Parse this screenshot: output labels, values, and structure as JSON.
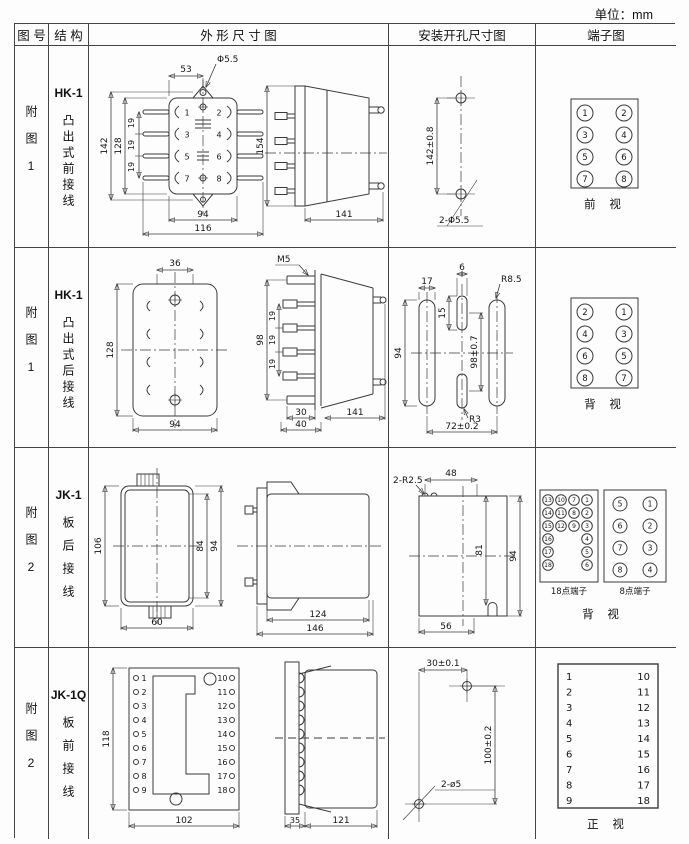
{
  "unit_label": "单位：mm",
  "header": {
    "figure": "图 号",
    "structure": "结 构",
    "outline": "外 形 尺 寸 图",
    "mounting": "安装开孔尺寸图",
    "terminal": "端子图"
  },
  "rows": [
    {
      "figure": "附图1",
      "model": "HK-1",
      "desc": "凸出式前接线",
      "outline": {
        "d53": "53",
        "dphi": "Φ5.5",
        "d142": "142",
        "d128": "128",
        "d19a": "19",
        "d19b": "19",
        "d19c": "19",
        "d94": "94",
        "d116": "116",
        "d154": "154",
        "d141": "141",
        "pins": [
          "1",
          "2",
          "3",
          "4",
          "5",
          "6",
          "7",
          "8"
        ]
      },
      "mounting": {
        "d142": "142±0.8",
        "holes": "2-Φ5.5"
      },
      "terminal": {
        "cells": [
          [
            "1",
            "2"
          ],
          [
            "3",
            "4"
          ],
          [
            "5",
            "6"
          ],
          [
            "7",
            "8"
          ]
        ],
        "view": "前 视"
      }
    },
    {
      "figure": "附图1",
      "model": "HK-1",
      "desc": "凸出式后接线",
      "outline": {
        "d36": "36",
        "d128": "128",
        "d94": "94",
        "m5": "M5",
        "d98": "98",
        "d19a": "19",
        "d19b": "19",
        "d19c": "19",
        "d30": "30",
        "d40": "40",
        "d141": "141"
      },
      "mounting": {
        "d17": "17",
        "d6": "6",
        "d15": "15",
        "d94": "94",
        "d98": "98±0.7",
        "r85": "R8.5",
        "r3": "R3",
        "d72": "72±0.2"
      },
      "terminal": {
        "cells": [
          [
            "2",
            "1"
          ],
          [
            "4",
            "3"
          ],
          [
            "6",
            "5"
          ],
          [
            "8",
            "7"
          ]
        ],
        "view": "背 视"
      }
    },
    {
      "figure": "附图2",
      "model": "JK-1",
      "desc": "板后接线",
      "outline": {
        "d106": "106",
        "d60": "60",
        "d84": "84",
        "d94": "94",
        "d124": "124",
        "d146": "146"
      },
      "mounting": {
        "r25": "2-R2.5",
        "d48": "48",
        "d81": "81",
        "d94": "94",
        "d56": "56"
      },
      "terminal": {
        "c18_1": [
          "13",
          "14",
          "15",
          "16",
          "17",
          "18"
        ],
        "c18_2": [
          "10",
          "11",
          "12"
        ],
        "c18_3": [
          "7",
          "8",
          "9"
        ],
        "c18_4": [
          "1",
          "2",
          "3",
          "4",
          "5",
          "6"
        ],
        "label18": "18点端子",
        "c8_1": [
          "5",
          "6",
          "7",
          "8"
        ],
        "c8_2": [
          "1",
          "2",
          "3",
          "4"
        ],
        "label8": "8点端子",
        "view": "背 视"
      }
    },
    {
      "figure": "附图2",
      "model": "JK-1Q",
      "desc": "板前接线",
      "outline": {
        "d118": "118",
        "d102": "102",
        "d35": "35",
        "d121": "121",
        "left_pins": [
          "1",
          "2",
          "3",
          "4",
          "5",
          "6",
          "7",
          "8",
          "9"
        ],
        "right_pins": [
          "10",
          "11",
          "12",
          "13",
          "14",
          "15",
          "16",
          "17",
          "18"
        ]
      },
      "mounting": {
        "d30": "30±0.1",
        "d100": "100±0.2",
        "holes": "2-ø5"
      },
      "terminal": {
        "left": [
          "1",
          "2",
          "3",
          "4",
          "5",
          "6",
          "7",
          "8",
          "9"
        ],
        "right": [
          "10",
          "11",
          "12",
          "13",
          "14",
          "15",
          "16",
          "17",
          "18"
        ],
        "view": "正 视"
      }
    }
  ]
}
